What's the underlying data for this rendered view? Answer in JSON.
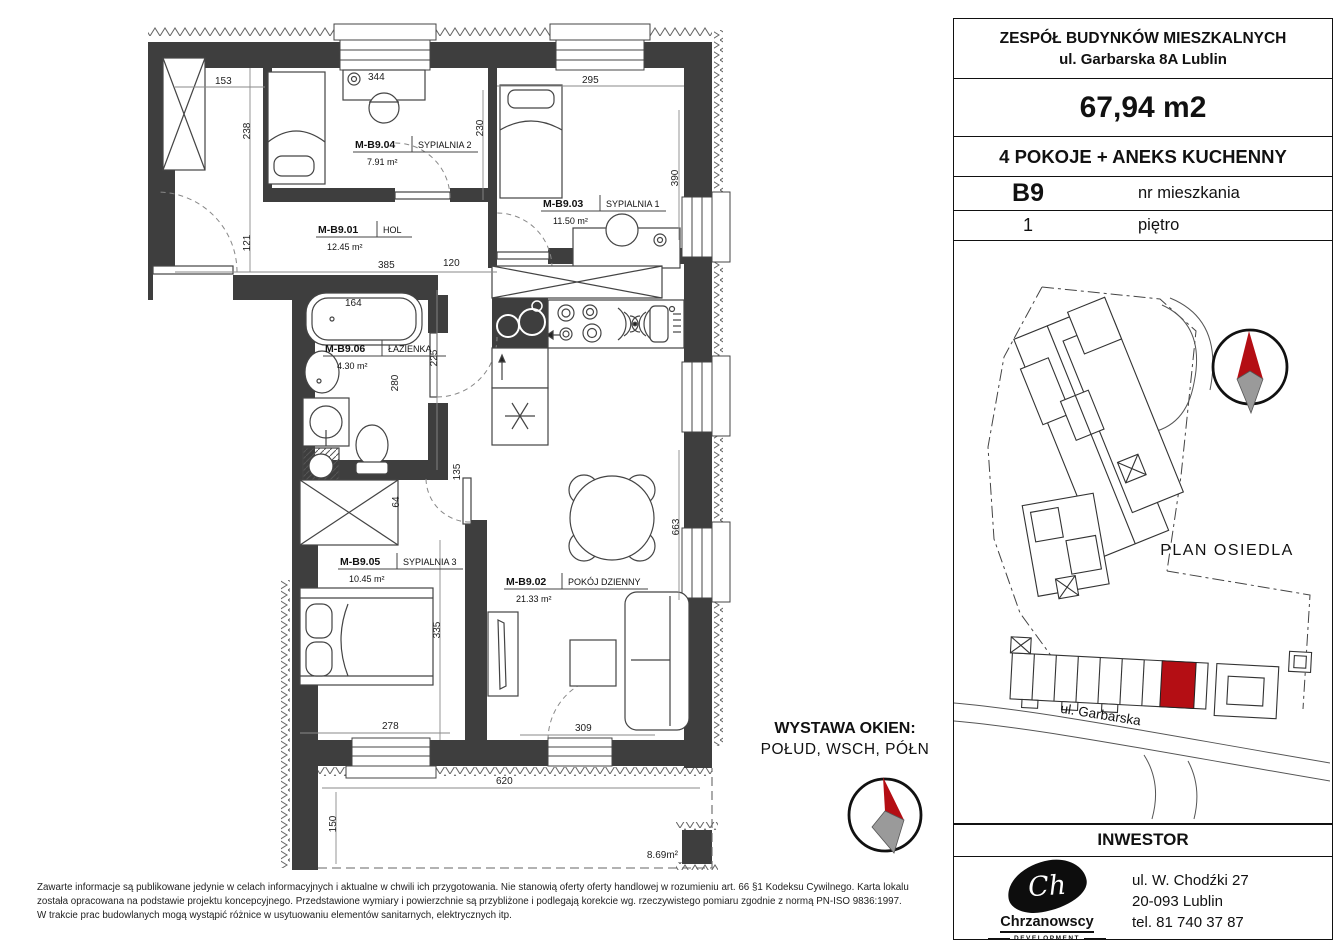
{
  "title_block": {
    "line1": "ZESPÓŁ BUDYNKÓW MIESZKALNYCH",
    "line2": "ul. Garbarska 8A  Lublin",
    "area": "67,94 m2",
    "layout": "4 POKOJE + ANEKS KUCHENNY",
    "unit_number": "B9",
    "unit_number_label": "nr mieszkania",
    "floor_number": "1",
    "floor_label": "piętro"
  },
  "floor_plan": {
    "rooms": [
      {
        "code": "M-B9.01",
        "name": "HOL",
        "area": "12.45 m²"
      },
      {
        "code": "M-B9.02",
        "name": "POKÓJ DZIENNY",
        "area": "21.33 m²"
      },
      {
        "code": "M-B9.03",
        "name": "SYPIALNIA 1",
        "area": "11.50 m²"
      },
      {
        "code": "M-B9.04",
        "name": "SYPIALNIA 2",
        "area": "7.91 m²"
      },
      {
        "code": "M-B9.05",
        "name": "SYPIALNIA 3",
        "area": "10.45 m²"
      },
      {
        "code": "M-B9.06",
        "name": "ŁAZIENKA",
        "area": "4.30 m²"
      }
    ],
    "balcony_area": "8.69m²",
    "dims": {
      "d153": "153",
      "d344": "344",
      "d295": "295",
      "d238": "238",
      "d230": "230",
      "d390": "390",
      "d121": "121",
      "d385": "385",
      "d120": "120",
      "d164": "164",
      "d225": "225",
      "d280": "280",
      "d135": "135",
      "d64": "64",
      "d335": "335",
      "d278": "278",
      "d309": "309",
      "d663": "663",
      "d620": "620",
      "d150": "150"
    }
  },
  "exposure": {
    "label": "WYSTAWA OKIEN:",
    "value": "POŁUD, WSCH, PÓŁN"
  },
  "site_plan": {
    "title": "PLAN OSIEDLA",
    "street": "ul. Garbarska",
    "highlight_color": "#b40e14"
  },
  "investor": {
    "header": "INWESTOR",
    "logo_monogram": "Ch",
    "company": "Chrzanowscy",
    "company_subtitle": "DEVELOPMENT",
    "address1": "ul. W. Chodźki 27",
    "address2": "20-093 Lublin",
    "phone": "tel. 81 740 37 87"
  },
  "disclaimer": {
    "line1": "Zawarte informacje są publikowane jedynie w celach informacyjnych i aktualne w chwili ich przygotowania. Nie stanowią oferty oferty handlowej w rozumieniu art. 66 §1 Kodeksu Cywilnego. Karta lokalu",
    "line2": "została opracowana na podstawie projektu koncepcyjnego. Przedstawione wymiary i powierzchnie są przybliżone i podlegają korekcie wg. rzeczywistego pomiaru zgodnie z normą PN-ISO 9836:1997.",
    "line3": "W trakcie prac budowlanych mogą wystąpić różnice w usytuowaniu elementów sanitarnych, elektrycznych itp."
  }
}
